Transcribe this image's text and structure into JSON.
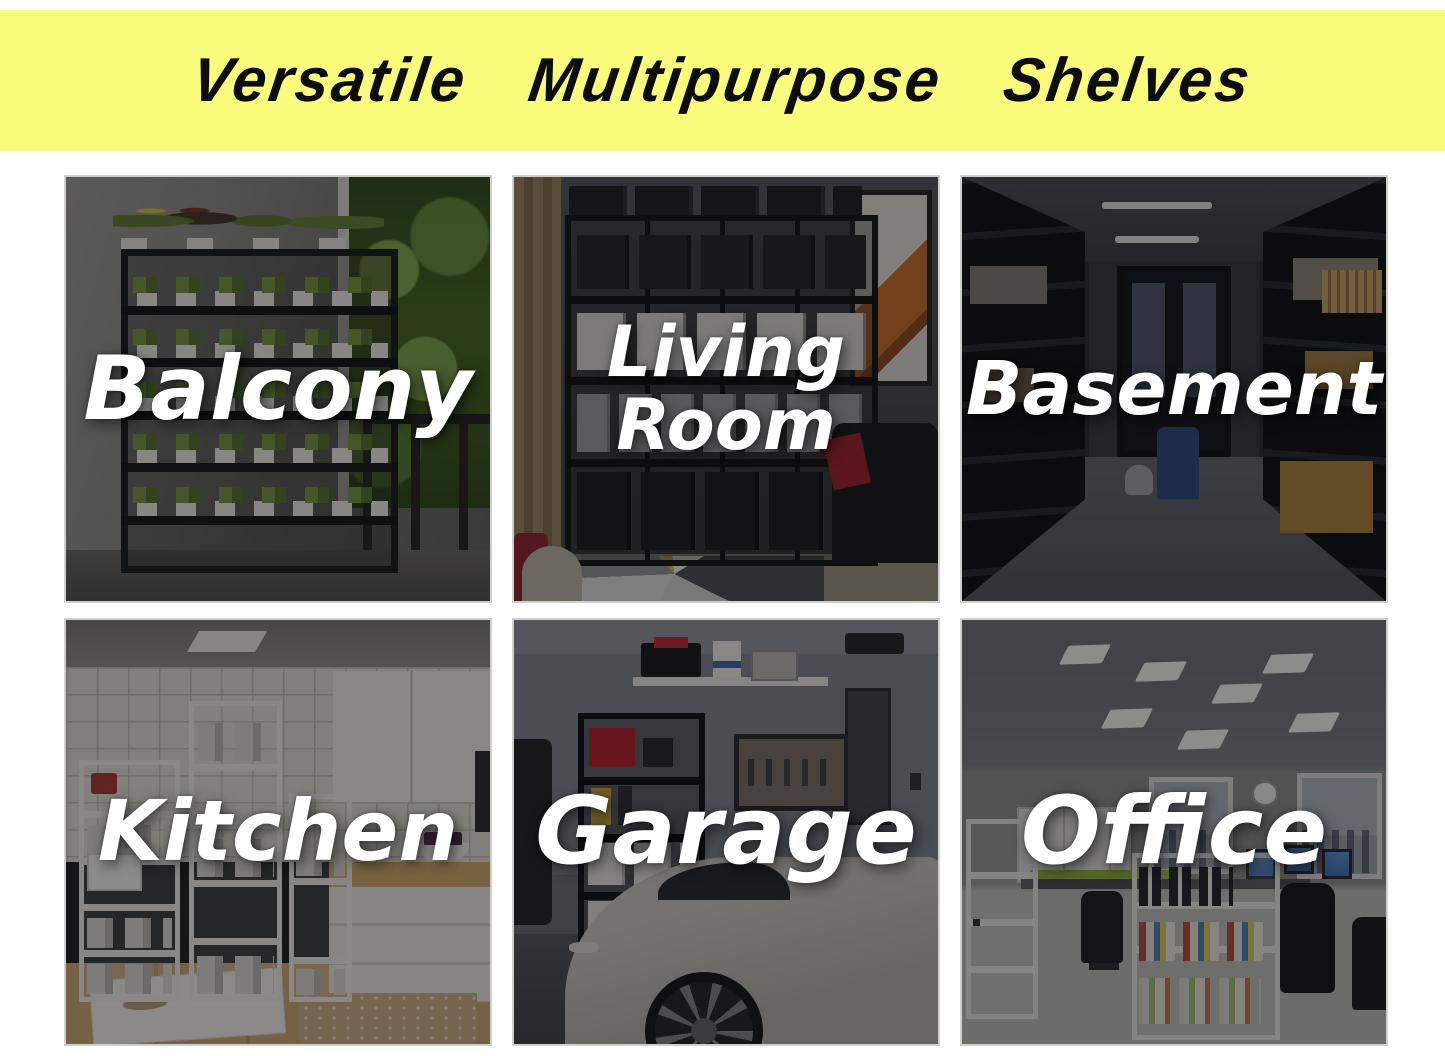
{
  "title_banner": {
    "title": "Versatile Multipurpose Shelves",
    "background_color": "#fafc7c",
    "text_color": "#0d0d0d"
  },
  "panels": [
    {
      "id": "balcony",
      "label": "Balcony"
    },
    {
      "id": "living-room",
      "label": "Living Room"
    },
    {
      "id": "basement",
      "label": "Basement"
    },
    {
      "id": "kitchen",
      "label": "Kitchen"
    },
    {
      "id": "garage",
      "label": "Garage"
    },
    {
      "id": "office",
      "label": "Office"
    }
  ],
  "style": {
    "label_text_color": "#ffffff",
    "photo_overlay_color": "rgba(10,10,12,0.44)",
    "page_background": "#ffffff"
  }
}
